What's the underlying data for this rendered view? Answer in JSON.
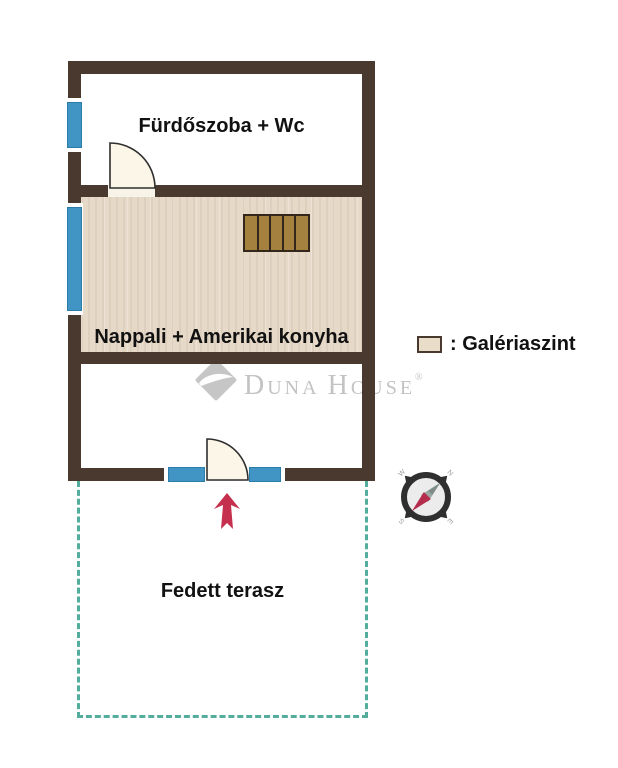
{
  "plan": {
    "rooms": {
      "bathroom": {
        "label": "Fürdőszoba + Wc"
      },
      "living": {
        "label": "Nappali + Amerikai konyha"
      },
      "terrace": {
        "label": "Fedett terasz"
      }
    },
    "legend": {
      "text": ": Galériaszint",
      "swatch_color": "#e9dcc9"
    },
    "watermark": {
      "part1": "D",
      "part2": "UNA",
      "part3": "H",
      "part4": "OUSE",
      "registered": "®"
    },
    "compass": {
      "nw": "W",
      "ne": "N",
      "se": "E",
      "sw": "S"
    },
    "colors": {
      "wall": "#4a392e",
      "gallery_floor": "#e6d9c7",
      "window_blue": "#4095c5",
      "terrace_dash": "#52ad9c",
      "entrance_arrow": "#c5304e",
      "stairs_wood": "#a5813f",
      "compass_needle_red": "#b52d4d",
      "compass_needle_gray": "#9aa8a4"
    }
  }
}
